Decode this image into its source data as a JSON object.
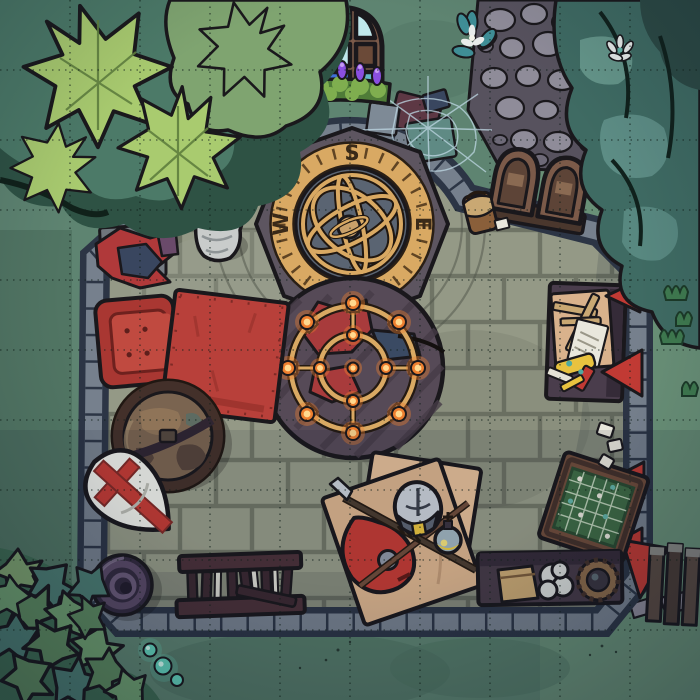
{
  "scene": {
    "title": "Abandoned chapel interior battle map (top-down)",
    "grid": {
      "cols": 10,
      "rows": 10,
      "cell_px": 70,
      "style": "dotted"
    }
  },
  "compass": {
    "letters": {
      "north": "N",
      "south": "S",
      "east": "E",
      "west": "W"
    }
  },
  "colors": {
    "outline": "#1a181c",
    "grid_line": "#101f1a",
    "grass_base": "#5e8471",
    "grass_light": "#729a7c",
    "grass_dark": "#4c7060",
    "grass_shadow": "#3e5f50",
    "floor": "#949986",
    "floor_line": "#50554a",
    "apse_floor": "#9ca192",
    "wall_dark": "#2c3545",
    "wall_stone": "#76808d",
    "rug": "#564a57",
    "rug_stripe": "#463c47",
    "gold": "#d9a963",
    "gold_dark": "#8a6428",
    "compass_platform": "#5d5560",
    "compass_disc": "#5a6472",
    "compass_letter": "#3a2a18",
    "flame_outer": "#ee7f2f",
    "flame_inner": "#ffd98f",
    "red_item": "#b8403a",
    "red_dark": "#8e2f2c",
    "chair_red": "#a93732",
    "cushion_red": "#c04a40",
    "banner_red": "#c13a34",
    "wood_brown": "#6f4c3a",
    "wood_dark": "#43302a",
    "plum_furniture": "#4a3d4c",
    "plum_dark": "#352b38",
    "tan_canvas": "#d9b28c",
    "tan_dark": "#b8916e",
    "paper_white": "#e9e7dc",
    "steel": "#c9ced6",
    "steel_dark": "#8d95a3",
    "glass_teal": "#62b9c8",
    "glass_blue": "#3e6fd8",
    "glass_pale": "#bfe8ec",
    "purple_candle": "#8a4fe0",
    "moss_green": "#7fae4f",
    "moss_dark": "#4f7c38",
    "leaf_light": "#a9cb6f",
    "leaf_mid": "#7fa470",
    "leaf_teal": "#4c7a68",
    "canopy_teal": "#3f6b63",
    "canopy_light": "#5d8d85",
    "canopy_shadow": "#2c4a45",
    "globe_brown": "#7a6450",
    "globe_dark": "#55433a",
    "globe_land": "#8f7458",
    "shield_white": "#edeee8",
    "pot_purple": "#4a3d55",
    "pot_dark": "#322a3e",
    "path_base": "#57525e",
    "pebble": "#8f8c99",
    "pebble_dark": "#6e6a78",
    "web": "#bfd8e4",
    "statue": "#c9cccb",
    "door_brown": "#7b5a49",
    "door_dark": "#4a372d",
    "bag_brown": "#8a5f3a",
    "board_green": "#3e6b44",
    "bench_maroon": "#4a3038",
    "glow_teal": "#63d4bd",
    "toy_yellow": "#e8c23f"
  },
  "objects": [
    {
      "id": "oak-tree",
      "label": "Large oak tree canopy (north-west)"
    },
    {
      "id": "dark-tree",
      "label": "Dark teal tree canopy (north-east)"
    },
    {
      "id": "stone-path",
      "label": "Cobblestone path to the door"
    },
    {
      "id": "stained-glass-window",
      "label": "Arched stained glass window"
    },
    {
      "id": "votive-candles",
      "label": "Purple votive candles on mossy ledge"
    },
    {
      "id": "cobweb-debris",
      "label": "Cobwebbed broken crates"
    },
    {
      "id": "compass-dais",
      "label": "Octagonal dais with compass ring"
    },
    {
      "id": "armillary-sphere",
      "label": "Golden armillary sphere"
    },
    {
      "id": "statue",
      "label": "Stone statue of a robed figure"
    },
    {
      "id": "cloth-pile",
      "label": "Pile of red and blue cloth on bench"
    },
    {
      "id": "armchair",
      "label": "Red armchair"
    },
    {
      "id": "red-rug-table",
      "label": "Red table rug"
    },
    {
      "id": "floor-globe",
      "label": "World globe in stand"
    },
    {
      "id": "crusader-shield",
      "label": "White kite shield with red cross"
    },
    {
      "id": "clay-pot",
      "label": "Purple clay pot"
    },
    {
      "id": "weapon-rack",
      "label": "Broken rack with blades"
    },
    {
      "id": "chandelier",
      "label": "Fallen wheel chandelier with lit candles"
    },
    {
      "id": "round-rug",
      "label": "Round dark rug"
    },
    {
      "id": "canvas-sheet",
      "label": "Canvas sheets with adventuring gear"
    },
    {
      "id": "knight-helmet",
      "label": "Steel great helm"
    },
    {
      "id": "potion-bottle",
      "label": "Potion bottle"
    },
    {
      "id": "spear",
      "label": "Spear"
    },
    {
      "id": "lute",
      "label": "Red lute"
    },
    {
      "id": "writing-desk",
      "label": "Desk with papers and trinkets"
    },
    {
      "id": "wall-banners",
      "label": "Red wall banners"
    },
    {
      "id": "game-table",
      "label": "Table with green game board"
    },
    {
      "id": "storage-table",
      "label": "Low table with pouch, bundle and coil"
    },
    {
      "id": "double-door",
      "label": "Arched double door"
    },
    {
      "id": "satchel",
      "label": "Leather satchel"
    },
    {
      "id": "ivy-bush",
      "label": "Ivy bush (south-west)"
    },
    {
      "id": "glowing-mushrooms",
      "label": "Glowing teal mushrooms"
    },
    {
      "id": "fence",
      "label": "Wooden fence (south-east)"
    },
    {
      "id": "flower",
      "label": "Teal flower"
    }
  ]
}
